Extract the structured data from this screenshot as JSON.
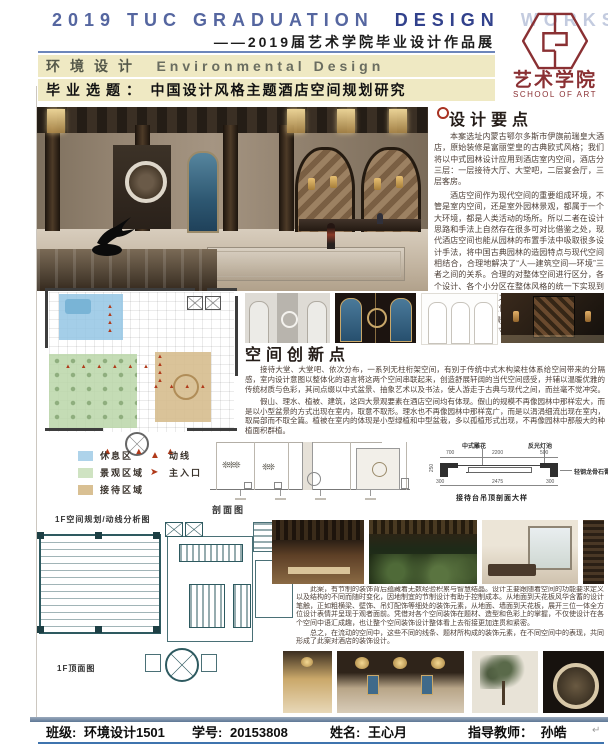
{
  "header": {
    "title_part1": "2019 TUC GRADUATION",
    "title_part2": "DESIGN",
    "title_part3": "WORKS",
    "subtitle": "——2019届艺术学院毕业设计作品展",
    "bar1_cn": "环境设计",
    "bar1_en": "Environmental Design",
    "bar2_label": "毕业选题：",
    "bar2_text": "中国设计风格主题酒店空间规划研究"
  },
  "logo": {
    "cn": "艺术学院",
    "en": "SCHOOL OF ART"
  },
  "design_points": {
    "title": "设计要点",
    "para1": "本案选址内蒙古鄂尔多斯市伊旗前瑞皇大酒店，原始装修是富丽堂皇的古典欧式风格；我们将以中式园林设计应用到酒店室内空间，酒店分三层：一层接待大厅、大堂吧，二层宴会厅，三层客房。",
    "para2": "酒店空间作为现代空间的重要组成环境，不管是室内空间，还是室外园林景观，都属于一个大环境，都是人类活动的场所。所以二者在设计思路和手法上自然存在很多可对比借鉴之处，现代酒店空间也能从园林的布置手法中吸取很多设计手法，将中国古典园林的造园特点与现代空间相结合，合理地解决了“人—建筑空间—环境”三者之间的关系。合理的对整体空间进行区分，各个设计、各个小分区在整体风格的统一下实现到各具特色，且相互之间又有一定的联系，而不是孤立存在的。通过借鉴中式园林的漏景、框景、借景、抑景、对景的手法使得各个空间相应成景，丰富空间的可观赏视角，空间的多视角画面而感觉促使顾客产生一种舒适的消费心情。"
  },
  "innovation": {
    "title": "空间创新点",
    "para1": "接待大堂、大堂吧、依次分布，一系列无柱桁架空间，有别于传统中式木构梁柱体系给空间带来的分隔感，室内设计意图以整体化的语言将这两个空间串联起来，创造舒展轩阔的当代空间感受，并辅以温暖优雅的传统材质与色彩，其间点缀以中式盆景、抽象艺术以及书法，使人游走于古典与现代之间，而丝毫不觉冲突。",
    "para2": "假山、理水、植被、建筑，这四大景观要素在酒店空间均有体现。假山的规模不再像园林中那样宏大，而是以小型盆景的方式出现在室内，取意不取形。理水也不再像园林中那样宽广，而是以涓涓细流出现在室内，取局部而不取全篇。植被在室内的体现是小型绿植和中型盆栽，多以孤植形式出现，不再像园林中那般大的种植面积群植。"
  },
  "plan": {
    "caption": "1F空间规划/动线分析图",
    "marker_row": "▲ ▲ ▲ ▲ ▲ ▲",
    "marker_row2": "▲ ▲ ▲ ▲",
    "marker_col": "▲▲▲▲",
    "entrance_markers": "▲ ▲ ▲",
    "legend": {
      "zones": [
        {
          "label": "休息区",
          "color": "#aed3ea"
        },
        {
          "label": "景观区域",
          "color": "#cfe3c2"
        },
        {
          "label": "接待区域",
          "color": "#d9c093"
        }
      ],
      "markers": [
        {
          "label": "动线",
          "symbol": "▲",
          "color": "#b03a1a"
        },
        {
          "label": "主入口",
          "symbol": "➤",
          "color": "#b03a1a"
        }
      ]
    }
  },
  "section_drawing": {
    "caption": "剖面图",
    "plant1": "❊❊❊",
    "plant2": "❊❊"
  },
  "ceiling_plan": {
    "caption": "1F顶面图"
  },
  "detail": {
    "caption": "接待台吊顶剖面大样",
    "label_carving": "中式雕花",
    "label_light": "反光灯池",
    "label_board": "轻钢龙骨石膏板",
    "dim_top_left": "700",
    "dim_top_mid": "2200",
    "dim_top_right": "500",
    "dim_bottom": "2475",
    "dim_corner_left": "300",
    "dim_corner_right": "300",
    "dim_height": "250"
  },
  "decor": {
    "para1": "此案，有节制的装饰背后蕴藏着无数经验积累与智慧结晶。设计主要跟随着空间的功能要求定义以及结构的不同而随时变化，因地制宜的节制设计有助于控制成本。从地面到天花板风华含蓄的设计笔触，正如粗横梁、壁饰、吊灯配饰等细处的装饰元素，从地面、墙面到天花板，展开三位一体全方位设计表情并呈现于观者面前。凭借对各个空间装饰在题材、造型和色彩上的掌握，不仅使设计在各个空间中语汇成趣，也让整个空间装饰设计整体看上去衔接更加连贯和紧密。",
    "para2": "总之，在流动的空间中，这些不同的线条、题材所构成的装饰元素，在不同空间中的表现，共同形成了此案对酒店的装饰设计。"
  },
  "footer": {
    "class_label": "班级:",
    "class_value": "环境设计1501",
    "id_label": "学号:",
    "id_value": "20153808",
    "name_label": "姓名:",
    "name_value": "王心月",
    "advisor_label": "指导教师：",
    "advisor_value": "孙皓",
    "return_mark": "↵"
  },
  "colors": {
    "accent_maroon": "#8a3033",
    "header_blue": "#5566a0",
    "bar_beige": "#efe9c3",
    "footer_blue": "#3f74ae",
    "marker_red": "#b03a1a",
    "plan_teal": "#2e5a60",
    "zone_blue": "#aed3ea",
    "zone_green": "#cfe3c2",
    "zone_tan": "#d9c093"
  }
}
